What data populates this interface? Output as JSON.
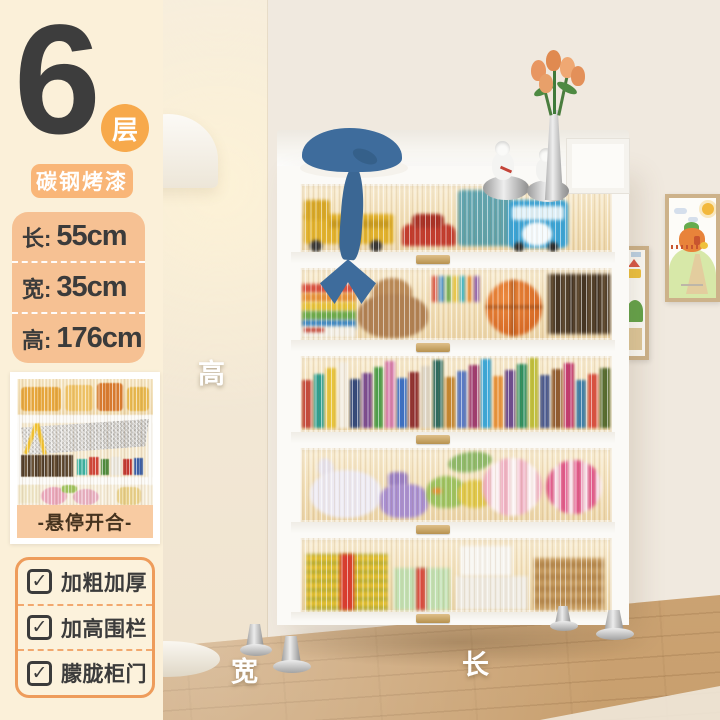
{
  "product": {
    "layer_count": "6",
    "layer_unit": "层",
    "material_badge": "碳钢烤漆"
  },
  "dimensions": {
    "rows": [
      {
        "label": "长:",
        "value": "55cm"
      },
      {
        "label": "宽:",
        "value": "35cm"
      },
      {
        "label": "高:",
        "value": "176cm"
      }
    ]
  },
  "thumbnail": {
    "caption": "-悬停开合-"
  },
  "features": [
    {
      "label": "加粗加厚"
    },
    {
      "label": "加高围栏"
    },
    {
      "label": "朦胧柜门"
    }
  ],
  "scene_labels": {
    "height": "高",
    "width": "宽",
    "length": "长"
  },
  "icons": {
    "checkbox_check": "✓"
  },
  "colors": {
    "sidebar_bg": "#FBF0D9",
    "accent_orange": "#F7A94B",
    "badge_orange": "#F9B678",
    "dims_bg": "#F6C193",
    "caption_bg": "#F8CBA2",
    "features_border": "#EE9C5B",
    "text_dark": "#3B3B3B",
    "wall": "#F0E9DF",
    "floor_wood": "#CFA97B",
    "cabinet_white": "#FBFAF7",
    "glass_amber": "#F2DFB7",
    "handle_gold": "#C9A25F"
  },
  "decor": {
    "book_palette": [
      "#C44A3C",
      "#2E9E8F",
      "#E8C43A",
      "#F2ECE0",
      "#31477A",
      "#7A4A8F",
      "#4A9E4A",
      "#D77FAE",
      "#3A6FC4",
      "#8F2F2F",
      "#DED6C6",
      "#2F6B5F",
      "#C4852F",
      "#5A7AC4",
      "#9E3A6F",
      "#3AA7D9",
      "#E8923A",
      "#6A4A8F",
      "#2E8F5F",
      "#BFBF3A",
      "#4A5A8F",
      "#8F5A2F",
      "#C23A6E",
      "#3E7FA8",
      "#D95040",
      "#556B2F"
    ]
  }
}
